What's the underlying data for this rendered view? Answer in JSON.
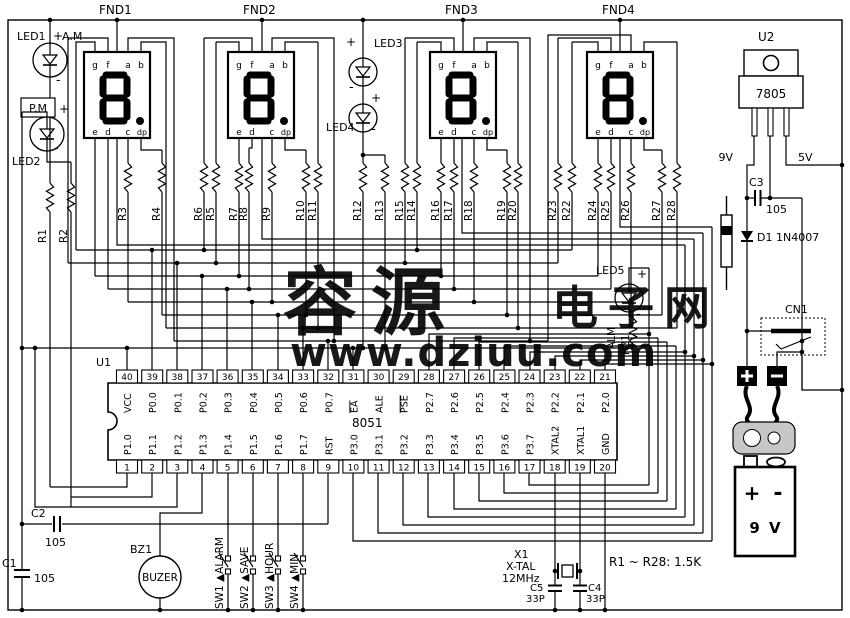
{
  "watermark": {
    "brand": "容源",
    "brand2": "电子网",
    "url": "www.dziuu.com",
    "brand_color": "#9db9ee",
    "brand2_color": "#f6c795",
    "url_color": "#a9cbab"
  },
  "displays": {
    "names": [
      "FND1",
      "FND2",
      "FND3",
      "FND4"
    ],
    "segment_top": [
      "g",
      "f",
      "a",
      "b"
    ],
    "segment_bottom": [
      "e",
      "d",
      "c",
      "dp"
    ],
    "digit": "8."
  },
  "leds": [
    {
      "ref": "LED1",
      "tag": "A.M",
      "plus": "+",
      "minus": "-"
    },
    {
      "ref": "LED2",
      "tag": "P.M",
      "plus": "+",
      "minus": "-"
    },
    {
      "ref": "LED3",
      "plus": "+",
      "minus": "-"
    },
    {
      "ref": "LED4",
      "plus": "+",
      "minus": "-"
    },
    {
      "ref": "LED5",
      "tag": "ALM",
      "plus": "+",
      "minus": "-"
    }
  ],
  "resistors": {
    "refs": [
      "R1",
      "R2",
      "R3",
      "R4",
      "R5",
      "R6",
      "R7",
      "R8",
      "R9",
      "R10",
      "R11",
      "R12",
      "R13",
      "R14",
      "R15",
      "R16",
      "R17",
      "R18",
      "R19",
      "R20",
      "R21",
      "R22",
      "R23",
      "R24",
      "R25",
      "R26",
      "R27",
      "R28"
    ],
    "note": "R1 ~ R28: 1.5K"
  },
  "ic": {
    "ref": "U1",
    "part": "8051",
    "pins_top": [
      {
        "n": "40",
        "label": "VCC"
      },
      {
        "n": "39",
        "label": "P0.0"
      },
      {
        "n": "38",
        "label": "P0.1"
      },
      {
        "n": "37",
        "label": "P0.2"
      },
      {
        "n": "36",
        "label": "P0.3"
      },
      {
        "n": "35",
        "label": "P0.4"
      },
      {
        "n": "34",
        "label": "P0.5"
      },
      {
        "n": "33",
        "label": "P0.6"
      },
      {
        "n": "32",
        "label": "P0.7"
      },
      {
        "n": "31",
        "label": "EA",
        "overline": true
      },
      {
        "n": "30",
        "label": "ALE"
      },
      {
        "n": "29",
        "label": "PSE",
        "overline": true
      },
      {
        "n": "28",
        "label": "P2.7"
      },
      {
        "n": "27",
        "label": "P2.6"
      },
      {
        "n": "26",
        "label": "P2.5"
      },
      {
        "n": "25",
        "label": "P2.4"
      },
      {
        "n": "24",
        "label": "P2.3"
      },
      {
        "n": "23",
        "label": "P2.2"
      },
      {
        "n": "22",
        "label": "P2.1"
      },
      {
        "n": "21",
        "label": "P2.0"
      }
    ],
    "pins_bottom": [
      {
        "n": "1",
        "label": "P1.0"
      },
      {
        "n": "2",
        "label": "P1.1"
      },
      {
        "n": "3",
        "label": "P1.2"
      },
      {
        "n": "4",
        "label": "P1.3"
      },
      {
        "n": "5",
        "label": "P1.4"
      },
      {
        "n": "6",
        "label": "P1.5"
      },
      {
        "n": "7",
        "label": "P1.6"
      },
      {
        "n": "8",
        "label": "P1.7"
      },
      {
        "n": "9",
        "label": "RST"
      },
      {
        "n": "10",
        "label": "P3.0"
      },
      {
        "n": "11",
        "label": "P3.1"
      },
      {
        "n": "12",
        "label": "P3.2"
      },
      {
        "n": "13",
        "label": "P3.3"
      },
      {
        "n": "14",
        "label": "P3.4"
      },
      {
        "n": "15",
        "label": "P3.5"
      },
      {
        "n": "16",
        "label": "P3.6"
      },
      {
        "n": "17",
        "label": "P3.7"
      },
      {
        "n": "18",
        "label": "XTAL2"
      },
      {
        "n": "19",
        "label": "XTAL1"
      },
      {
        "n": "20",
        "label": "GND"
      }
    ]
  },
  "caps": [
    {
      "ref": "C1",
      "val": "105"
    },
    {
      "ref": "C2",
      "val": "105"
    },
    {
      "ref": "C3",
      "val": "105"
    },
    {
      "ref": "C4",
      "val": "33P"
    },
    {
      "ref": "C5",
      "val": "33P"
    }
  ],
  "power": {
    "u2_ref": "U2",
    "u2_part": "7805",
    "rail_in": "9V",
    "rail_out": "5V",
    "d1_label": "D1 1N4007",
    "cn1_ref": "CN1",
    "battery_plus": "+",
    "battery_minus": "-",
    "battery_label": "9 V"
  },
  "buzzer": {
    "ref": "BZ1",
    "label": "BUZER"
  },
  "switches": [
    {
      "ref": "SW1",
      "label": "ALARM"
    },
    {
      "ref": "SW2",
      "label": "SAVE"
    },
    {
      "ref": "SW3",
      "label": "HOUR"
    },
    {
      "ref": "SW4",
      "label": "MIN"
    }
  ],
  "crystal": {
    "ref": "X1",
    "type": "X-TAL",
    "freq": "12MHz"
  }
}
